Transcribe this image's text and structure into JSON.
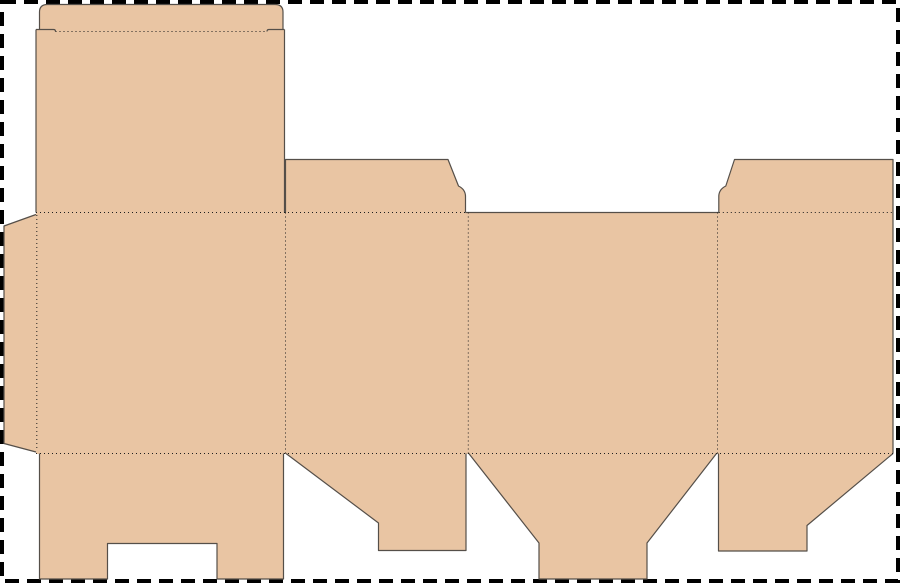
{
  "canvas": {
    "width": 900,
    "height": 584,
    "background_color": "#ffffff"
  },
  "border": {
    "x": 2,
    "y": 2,
    "width": 896,
    "height": 579,
    "color": "#000000",
    "stroke_width": 4,
    "dash": "14 8"
  },
  "dieline": {
    "fill_color": "#e9c5a3",
    "cut_color": "#554f49",
    "fold_color": "#1f1f1f",
    "cut_stroke_width": 1.2,
    "fold_stroke_width": 1,
    "fold_dash": "1 3",
    "fills": [
      {
        "name": "tuck-flap",
        "path": "M39.5,32 V12 Q39.5,4.5 47.5,4.5 H275 Q283,4.5 283,12 V32 Z"
      },
      {
        "name": "lid-panel",
        "path": "M36,29.5 H284.5 V213 H36 Z"
      },
      {
        "name": "body-panels",
        "path": "M36,212 H893 V454 H36 Z"
      },
      {
        "name": "glue-flap",
        "path": "M36,214.5 V452 L4,443.5 V226 Z"
      },
      {
        "name": "dust-flap-left",
        "path": "M285.5,213 V159.5 H448 L458.5,186 Q465.5,189.5 465.5,196.5 V213 Z"
      },
      {
        "name": "dust-flap-right",
        "path": "M718.8,213 V196.5 Q718.8,189.5 725.8,186 L734.5,159.5 H893 V213 Z"
      },
      {
        "name": "bottom-flap-back",
        "path": "M39.5,453 H283.5 V579 H217 V543.5 H107.5 V579 H39.5 Z"
      },
      {
        "name": "bottom-flap-side-left",
        "path": "M286,453 H466 V550.5 H378.5 V523 Z"
      },
      {
        "name": "bottom-flap-front",
        "path": "M468.8,453 H716.5 L647,543 V579 H539 V543 Z"
      },
      {
        "name": "bottom-flap-side-right",
        "path": "M718.5,453 H893 L807,525.5 V551 H718.5 Z"
      }
    ],
    "cuts": [
      {
        "name": "tuck-flap-outline",
        "path": "M39.5,29.5 V12 Q39.5,4.5 47.5,4.5 H275 Q283,4.5 283,12 V29.5"
      },
      {
        "name": "tuck-shoulder-left",
        "path": "M36,29.5 H53.5 Q55.5,29.5 55.5,31.5"
      },
      {
        "name": "tuck-shoulder-right",
        "path": "M267,31.5 Q267,29.5 269,29.5 H284.5"
      },
      {
        "name": "lid-left-edge",
        "path": "M36,29.5 V212.5"
      },
      {
        "name": "lid-right-edge",
        "path": "M284.5,29.5 V212.5"
      },
      {
        "name": "glue-flap-edge",
        "path": "M36,214.5 L4,226 V443.5 L36,452"
      },
      {
        "name": "dust-flap-left-edge",
        "path": "M285.5,212.5 V159.5 H448 L458.5,186 Q465.5,189.5 465.5,196.5 V212.5"
      },
      {
        "name": "front-panel-top-edge",
        "path": "M465.5,212.5 H718.8"
      },
      {
        "name": "dust-flap-right-edge",
        "path": "M718.8,212.5 V196.5 Q718.8,189.5 725.8,186 L734.5,159.5 H893 V212.5"
      },
      {
        "name": "body-right-edge",
        "path": "M893,212.5 V453.5"
      },
      {
        "name": "bottom-flap-back-edge",
        "path": "M39.5,453.5 V579 H107.5 V543.5 H217 V579 H283.5 V453.5"
      },
      {
        "name": "bottom-flap-side-left-edge",
        "path": "M286,453.5 L378.5,523 V550.5 H466 V453.5"
      },
      {
        "name": "bottom-flap-front-edge",
        "path": "M468.8,453.5 L539,543 V579 H647 V543 L716.5,453.5"
      },
      {
        "name": "bottom-flap-side-right-edge",
        "path": "M718.5,453.5 V551 H807 V525.5 L893,453.5"
      }
    ],
    "folds": [
      {
        "name": "tuck-flap-fold",
        "path": "M55.5,31.5 H267"
      },
      {
        "name": "top-fold-left",
        "path": "M36,212.5 H465.5"
      },
      {
        "name": "top-fold-right",
        "path": "M718.8,212.5 H893"
      },
      {
        "name": "bottom-fold",
        "path": "M36,453.5 H893"
      },
      {
        "name": "glue-flap-fold",
        "path": "M36.8,215 V451"
      },
      {
        "name": "column-fold-1",
        "path": "M285.5,212.5 V453.5"
      },
      {
        "name": "column-fold-2",
        "path": "M468.3,212.5 V453.5"
      },
      {
        "name": "column-fold-3",
        "path": "M717.5,212.5 V453.5"
      }
    ]
  }
}
